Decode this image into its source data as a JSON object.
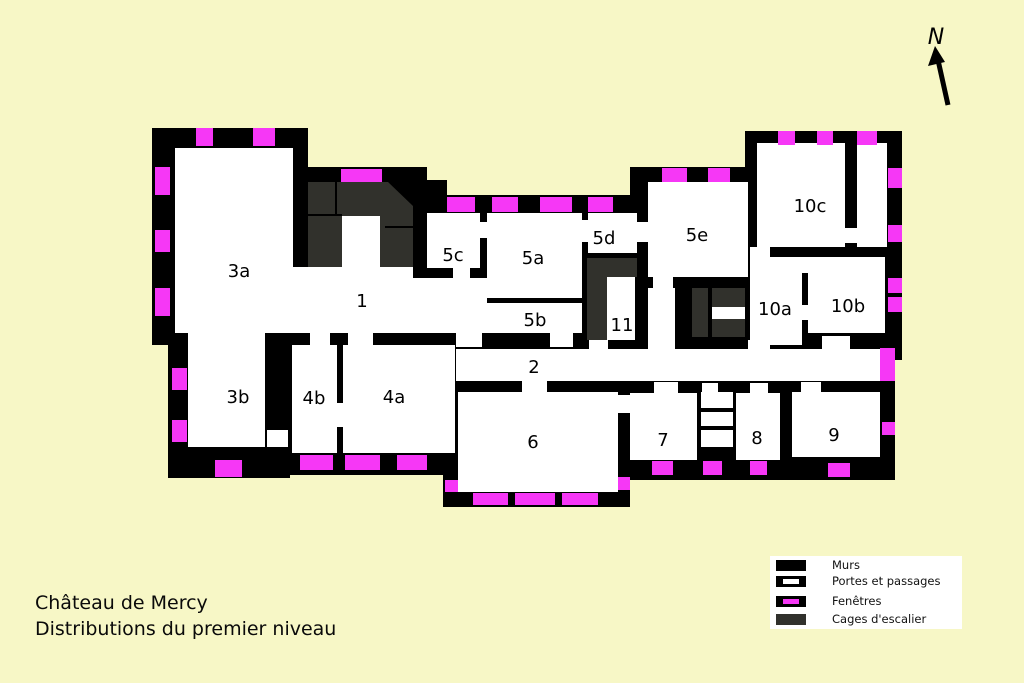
{
  "title": {
    "line1": "Château de Mercy",
    "line2": "Distributions du premier niveau"
  },
  "compass": {
    "label": "N"
  },
  "rooms": {
    "r1": "1",
    "r2": "2",
    "r3a": "3a",
    "r3b": "3b",
    "r4a": "4a",
    "r4b": "4b",
    "r5a": "5a",
    "r5b": "5b",
    "r5c": "5c",
    "r5d": "5d",
    "r5e": "5e",
    "r6": "6",
    "r7": "7",
    "r8": "8",
    "r9": "9",
    "r10a": "10a",
    "r10b": "10b",
    "r10c": "10c",
    "r11": "11"
  },
  "legend": {
    "items": [
      {
        "label": "Murs",
        "swatch": "wall"
      },
      {
        "label": "Portes et passages",
        "swatch": "door"
      },
      {
        "label": "Fenêtres",
        "swatch": "window"
      },
      {
        "label": "Cages d'escalier",
        "swatch": "stair"
      }
    ]
  },
  "colors": {
    "background": "#F7F7C6",
    "wall": "#000000",
    "window": "#F637F6",
    "stair": "#31312C",
    "room": "#FFFFFF"
  }
}
